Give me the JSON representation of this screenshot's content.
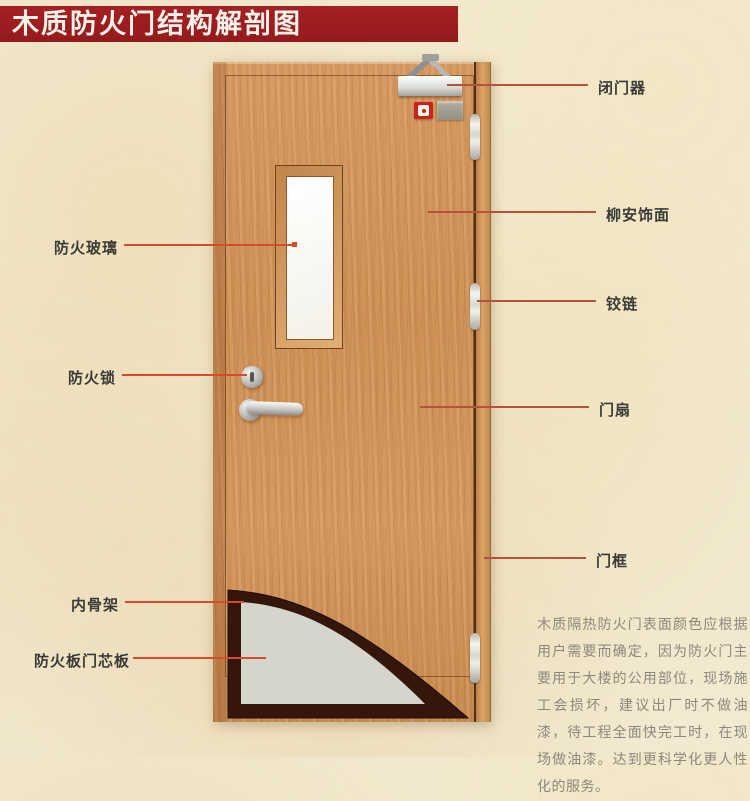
{
  "title": "木质防火门结构解剖图",
  "diagram": {
    "left_labels": [
      {
        "id": "fire-glass",
        "label": "防火玻璃"
      },
      {
        "id": "fire-lock",
        "label": "防火锁"
      },
      {
        "id": "inner-skeleton",
        "label": "内骨架"
      },
      {
        "id": "fire-board-core",
        "label": "防火板门芯板"
      }
    ],
    "right_labels": [
      {
        "id": "door-closer",
        "label": "闭门器"
      },
      {
        "id": "lauan-veneer",
        "label": "柳安饰面"
      },
      {
        "id": "hinge",
        "label": "铰链"
      },
      {
        "id": "door-leaf",
        "label": "门扇"
      },
      {
        "id": "door-frame",
        "label": "门框"
      }
    ],
    "description": "木质隔热防火门表面颜色应根据用户需要而确定，因为防火门主要用于大楼的公用部位，现场施工会损坏，建议出厂时不做油漆，待工程全面快完工时，在现场做油漆。达到更科学化更人性化的服务。"
  },
  "colors": {
    "banner_red": "#9e1c1e",
    "background_beige": "#f2e9d0",
    "wood": "#d2955c",
    "callout_red_left": "#d94a2c",
    "callout_red_right": "#b8503e",
    "core_grey": "#d6d5cc",
    "skeleton_dark_brown": "#35160d",
    "label_text": "#3a3a38",
    "description_text": "#8d887c"
  }
}
